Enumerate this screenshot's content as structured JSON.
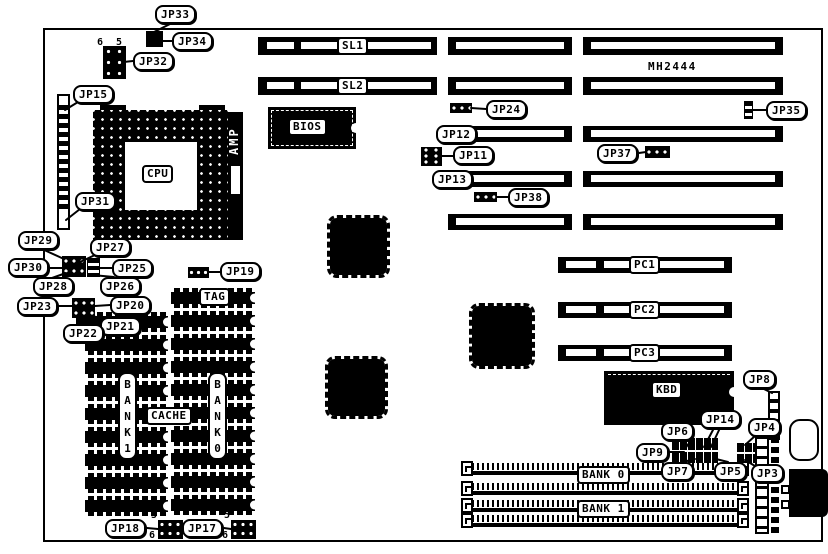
{
  "board": {
    "model": "MH2444"
  },
  "parts": {
    "cpu": "CPU",
    "amp": "AMP",
    "bios": "BIOS",
    "kbd": "KBD"
  },
  "memory": {
    "tag": "TAG",
    "cache": "CACHE",
    "bank1_vertical": "BANK1",
    "bank0_vertical": "BANK0",
    "simm_bank0": "BANK 0",
    "simm_bank1": "BANK 1",
    "chip_columns": [
      {
        "x": 85,
        "w": 83,
        "first_y": 312,
        "count": 9,
        "pitch": 23,
        "h": 20
      },
      {
        "x": 171,
        "w": 84,
        "first_y": 288,
        "count": 10,
        "pitch": 23,
        "h": 20
      }
    ],
    "simm_x": 467,
    "simm_w": 277,
    "simm_rows": [
      463,
      483,
      500,
      515
    ]
  },
  "slots": [
    {
      "name": "sl1-a",
      "x": 258,
      "y": 37,
      "w": 179,
      "h": 18,
      "inner": [
        [
          9,
          27
        ],
        [
          43,
          130
        ]
      ],
      "label": "SL1",
      "label_x": 337
    },
    {
      "name": "sl1-b",
      "x": 448,
      "y": 37,
      "w": 124,
      "h": 18,
      "inner": [
        [
          8,
          108
        ]
      ]
    },
    {
      "name": "sl1-c",
      "x": 583,
      "y": 37,
      "w": 200,
      "h": 18,
      "inner": [
        [
          8,
          184
        ]
      ]
    },
    {
      "name": "sl2-a",
      "x": 258,
      "y": 77,
      "w": 179,
      "h": 18,
      "inner": [
        [
          9,
          27
        ],
        [
          43,
          130
        ]
      ],
      "label": "SL2",
      "label_x": 337
    },
    {
      "name": "sl2-b",
      "x": 448,
      "y": 77,
      "w": 124,
      "h": 18,
      "inner": [
        [
          8,
          108
        ]
      ]
    },
    {
      "name": "sl2-c",
      "x": 583,
      "y": 77,
      "w": 200,
      "h": 18,
      "inner": [
        [
          8,
          184
        ]
      ]
    },
    {
      "name": "isa3-b",
      "x": 448,
      "y": 126,
      "w": 124,
      "h": 16,
      "inner": [
        [
          8,
          108
        ]
      ]
    },
    {
      "name": "isa3-c",
      "x": 583,
      "y": 126,
      "w": 200,
      "h": 16,
      "inner": [
        [
          8,
          184
        ]
      ]
    },
    {
      "name": "isa4-b",
      "x": 448,
      "y": 171,
      "w": 124,
      "h": 16,
      "inner": [
        [
          8,
          108
        ]
      ]
    },
    {
      "name": "isa4-c",
      "x": 583,
      "y": 171,
      "w": 200,
      "h": 16,
      "inner": [
        [
          8,
          184
        ]
      ]
    },
    {
      "name": "isa5-b",
      "x": 448,
      "y": 214,
      "w": 124,
      "h": 16,
      "inner": [
        [
          8,
          108
        ]
      ]
    },
    {
      "name": "isa5-c",
      "x": 583,
      "y": 214,
      "w": 200,
      "h": 16,
      "inner": [
        [
          8,
          184
        ]
      ]
    },
    {
      "name": "pc1",
      "x": 558,
      "y": 257,
      "w": 174,
      "h": 16,
      "inner": [
        [
          8,
          30
        ],
        [
          46,
          120
        ]
      ],
      "label": "PC1",
      "label_x": 629
    },
    {
      "name": "pc2",
      "x": 558,
      "y": 302,
      "w": 174,
      "h": 16,
      "inner": [
        [
          8,
          30
        ],
        [
          46,
          120
        ]
      ],
      "label": "PC2",
      "label_x": 629
    },
    {
      "name": "pc3",
      "x": 558,
      "y": 345,
      "w": 174,
      "h": 16,
      "inner": [
        [
          8,
          30
        ],
        [
          46,
          120
        ]
      ],
      "label": "PC3",
      "label_x": 629
    }
  ],
  "jumpers": [
    {
      "id": "JP33",
      "x": 155,
      "y": 5
    },
    {
      "id": "JP34",
      "x": 172,
      "y": 32
    },
    {
      "id": "JP32",
      "x": 133,
      "y": 52
    },
    {
      "id": "JP15",
      "x": 73,
      "y": 85
    },
    {
      "id": "JP31",
      "x": 75,
      "y": 192
    },
    {
      "id": "JP29",
      "x": 18,
      "y": 231
    },
    {
      "id": "JP27",
      "x": 90,
      "y": 238
    },
    {
      "id": "JP30",
      "x": 8,
      "y": 258
    },
    {
      "id": "JP25",
      "x": 112,
      "y": 259
    },
    {
      "id": "JP28",
      "x": 33,
      "y": 277
    },
    {
      "id": "JP26",
      "x": 100,
      "y": 277
    },
    {
      "id": "JP23",
      "x": 17,
      "y": 297
    },
    {
      "id": "JP20",
      "x": 110,
      "y": 296
    },
    {
      "id": "JP21",
      "x": 100,
      "y": 317
    },
    {
      "id": "JP22",
      "x": 63,
      "y": 324
    },
    {
      "id": "JP19",
      "x": 220,
      "y": 262
    },
    {
      "id": "JP24",
      "x": 486,
      "y": 100
    },
    {
      "id": "JP12",
      "x": 436,
      "y": 125
    },
    {
      "id": "JP11",
      "x": 453,
      "y": 146
    },
    {
      "id": "JP13",
      "x": 432,
      "y": 170
    },
    {
      "id": "JP38",
      "x": 508,
      "y": 188
    },
    {
      "id": "JP37",
      "x": 597,
      "y": 144
    },
    {
      "id": "JP35",
      "x": 766,
      "y": 101
    },
    {
      "id": "JP8",
      "x": 743,
      "y": 370
    },
    {
      "id": "JP4",
      "x": 748,
      "y": 418
    },
    {
      "id": "JP14",
      "x": 700,
      "y": 410
    },
    {
      "id": "JP6",
      "x": 661,
      "y": 422
    },
    {
      "id": "JP9",
      "x": 636,
      "y": 443
    },
    {
      "id": "JP7",
      "x": 661,
      "y": 462
    },
    {
      "id": "JP5",
      "x": 714,
      "y": 462
    },
    {
      "id": "JP3",
      "x": 751,
      "y": 464
    },
    {
      "id": "JP18",
      "x": 105,
      "y": 519
    },
    {
      "id": "JP17",
      "x": 182,
      "y": 519
    }
  ],
  "headers": [
    {
      "name": "jp33-header",
      "x": 146,
      "y": 31,
      "w": 17,
      "h": 16,
      "s": "solid"
    },
    {
      "name": "jp32-header",
      "x": 103,
      "y": 46,
      "w": 23,
      "h": 33,
      "s": "dots",
      "dx": 11,
      "dy": 11
    },
    {
      "name": "jp27-header",
      "x": 62,
      "y": 256,
      "w": 24,
      "h": 21,
      "s": "dots",
      "dx": 8,
      "dy": 10
    },
    {
      "name": "jp25-header",
      "x": 87,
      "y": 258,
      "w": 13,
      "h": 19,
      "s": "hstripes"
    },
    {
      "name": "jp20-header",
      "x": 72,
      "y": 298,
      "w": 23,
      "h": 20,
      "s": "dots",
      "dx": 8,
      "dy": 10
    },
    {
      "name": "jp22-header",
      "x": 76,
      "y": 318,
      "w": 10,
      "h": 10,
      "s": "solid"
    },
    {
      "name": "jp19-header",
      "x": 188,
      "y": 267,
      "w": 21,
      "h": 11,
      "s": "dots",
      "dx": 7,
      "dy": 11
    },
    {
      "name": "jp24-header",
      "x": 450,
      "y": 103,
      "w": 22,
      "h": 10,
      "s": "dots",
      "dx": 8,
      "dy": 10
    },
    {
      "name": "jp11-header",
      "x": 421,
      "y": 147,
      "w": 21,
      "h": 19,
      "s": "dots",
      "dx": 10,
      "dy": 6
    },
    {
      "name": "jp38-header",
      "x": 474,
      "y": 192,
      "w": 23,
      "h": 10,
      "s": "dots",
      "dx": 8,
      "dy": 10
    },
    {
      "name": "jp37-header",
      "x": 645,
      "y": 146,
      "w": 25,
      "h": 12,
      "s": "dots",
      "dx": 8,
      "dy": 12
    },
    {
      "name": "jp35-header",
      "x": 744,
      "y": 101,
      "w": 9,
      "h": 18,
      "s": "hstripes"
    },
    {
      "name": "jp8-header",
      "x": 768,
      "y": 391,
      "w": 12,
      "h": 49,
      "s": "vcells"
    },
    {
      "name": "jp6-header",
      "x": 672,
      "y": 438,
      "w": 46,
      "h": 25,
      "s": "grid"
    },
    {
      "name": "jp5-header",
      "x": 737,
      "y": 443,
      "w": 18,
      "h": 20,
      "s": "grid"
    },
    {
      "name": "jp18-header",
      "x": 158,
      "y": 520,
      "w": 25,
      "h": 19,
      "s": "dots",
      "dx": 8,
      "dy": 9
    },
    {
      "name": "jp17-header",
      "x": 231,
      "y": 520,
      "w": 25,
      "h": 19,
      "s": "dots",
      "dx": 8,
      "dy": 9
    },
    {
      "name": "power-pin-column",
      "x": 755,
      "y": 437,
      "w": 14,
      "h": 97,
      "s": "wcells"
    },
    {
      "name": "power-strip",
      "x": 771,
      "y": 437,
      "w": 8,
      "h": 97,
      "s": "vdash"
    }
  ],
  "pin_numbers": [
    {
      "text": "6",
      "x": 97,
      "y": 38
    },
    {
      "text": "5",
      "x": 116,
      "y": 38
    },
    {
      "text": "5",
      "x": 151,
      "y": 511
    },
    {
      "text": "6",
      "x": 149,
      "y": 531
    },
    {
      "text": "5",
      "x": 224,
      "y": 511
    },
    {
      "text": "6",
      "x": 222,
      "y": 531
    }
  ],
  "callout_lines": [
    [
      172,
      23,
      152,
      33
    ],
    [
      172,
      41,
      160,
      41
    ],
    [
      133,
      61,
      124,
      62
    ],
    [
      78,
      102,
      65,
      110
    ],
    [
      80,
      209,
      66,
      220
    ],
    [
      42,
      249,
      64,
      259
    ],
    [
      95,
      255,
      80,
      262
    ],
    [
      50,
      268,
      63,
      268
    ],
    [
      112,
      268,
      100,
      268
    ],
    [
      52,
      278,
      66,
      273
    ],
    [
      114,
      277,
      92,
      275
    ],
    [
      59,
      306,
      73,
      306
    ],
    [
      110,
      305,
      95,
      306
    ],
    [
      103,
      318,
      90,
      316
    ],
    [
      79,
      324,
      80,
      317
    ],
    [
      220,
      272,
      208,
      272
    ],
    [
      486,
      109,
      471,
      108
    ],
    [
      453,
      156,
      441,
      156
    ],
    [
      508,
      197,
      496,
      197
    ],
    [
      639,
      153,
      646,
      152
    ],
    [
      766,
      110,
      752,
      110
    ],
    [
      762,
      388,
      772,
      393
    ],
    [
      684,
      440,
      690,
      449
    ],
    [
      714,
      428,
      704,
      447
    ],
    [
      720,
      428,
      711,
      447
    ],
    [
      670,
      452,
      684,
      452
    ],
    [
      683,
      462,
      695,
      459
    ],
    [
      728,
      462,
      716,
      459
    ],
    [
      755,
      436,
      745,
      445
    ],
    [
      755,
      466,
      745,
      460
    ],
    [
      147,
      528,
      158,
      529
    ],
    [
      224,
      528,
      231,
      529
    ],
    [
      138,
      415,
      148,
      415
    ],
    [
      196,
      415,
      208,
      415
    ]
  ]
}
